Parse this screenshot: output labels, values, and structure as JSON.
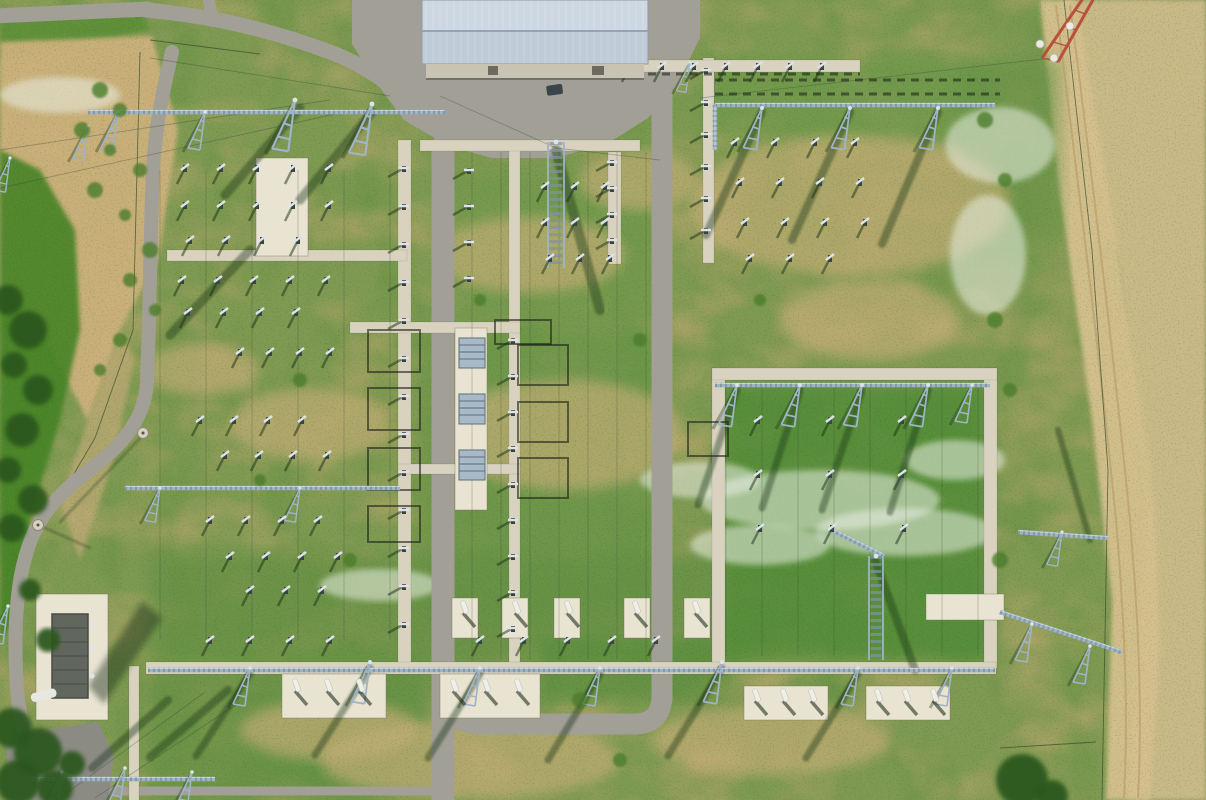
{
  "meta": {
    "title": "Aerial drone view of a high-voltage electrical substation with lattice gantries, access roads and a service building",
    "width": 1206,
    "height": 800
  },
  "palette": {
    "grass_base": "#7f9a52",
    "grass_rich": "#4f8c36",
    "dry_patch": "#bfa96f",
    "dry_patch2": "#c3ae74",
    "sand": "#cdb27c",
    "dry_field": "#c9ba88",
    "track": "#d6c18f",
    "asphalt": "#a19f96",
    "asphalt_dark": "#8c8b83",
    "concrete": "#d9d2bf",
    "concrete_bright": "#e9e3d2",
    "roof": "#bfcbd7",
    "roof_light": "#cdd7e1",
    "roof_ridge": "#93a5b6",
    "wall": "#c9c3b4",
    "steel": "#9fb4c4",
    "steel_light": "#dce4ea",
    "shadow": "rgba(25,48,20,0.5)",
    "frame_dark": "rgba(28,34,24,0.75)",
    "tree": "#2a571f",
    "shrub": "#4c7d2c",
    "flower": "rgba(233,239,227,0.55)",
    "fence": "rgba(60,80,50,0.75)",
    "red_tower": "#b8503a",
    "white": "#efefe8"
  },
  "scene": {
    "regions": [
      {
        "name": "verge-topleft",
        "pts": "0,18 140,8 150,30 60,48 0,60",
        "fill": "#5d9038",
        "op": 0.9
      },
      {
        "name": "sand-topleft",
        "pts": "0,42 152,36 178,130 158,260 120,330 88,420 40,330 0,310",
        "fill": "#cdb27c",
        "op": 0.95
      },
      {
        "name": "sand-tail",
        "pts": "88,420 120,330 135,360 110,470 80,560 60,500",
        "fill": "#c3ac79",
        "op": 0.7
      },
      {
        "name": "left-vegetation",
        "pts": "0,150 40,170 75,230 80,330 60,420 30,520 15,620 0,640",
        "fill": "#468427",
        "op": 0.9
      },
      {
        "name": "right-dry-field",
        "pts": "1062,0 1206,0 1206,800 1128,800 1150,480 1118,260 1068,80",
        "fill": "#c9ba88",
        "op": 1
      },
      {
        "name": "dirt-track",
        "pts": "1040,0 1076,0 1118,250 1152,470 1160,640 1150,800 1106,800 1112,600 1092,420 1058,180",
        "fill": "#d6c18f",
        "op": 0.95
      }
    ],
    "green_blobs": [
      [
        420,
        330,
        240,
        290,
        "#6a9647",
        0.75
      ],
      [
        718,
        382,
        272,
        280,
        "#4f8c36",
        0.8
      ],
      [
        700,
        58,
        300,
        80,
        "#6d9a49",
        0.7
      ],
      [
        150,
        555,
        570,
        110,
        "#659145",
        0.7
      ],
      [
        430,
        175,
        230,
        150,
        "#719a4c",
        0.7
      ],
      [
        540,
        640,
        180,
        60,
        "#568d3a",
        0.6
      ],
      [
        150,
        660,
        280,
        140,
        "#5f9040",
        0.65
      ],
      [
        960,
        60,
        100,
        200,
        "#679447",
        0.6
      ]
    ],
    "dirt_ellipses": [
      [
        530,
        255,
        95,
        38
      ],
      [
        565,
        435,
        120,
        55
      ],
      [
        850,
        205,
        160,
        70
      ],
      [
        310,
        425,
        80,
        36
      ],
      [
        470,
        760,
        150,
        40
      ],
      [
        770,
        740,
        120,
        35
      ],
      [
        640,
        180,
        60,
        30
      ],
      [
        870,
        320,
        90,
        40
      ],
      [
        330,
        730,
        90,
        30
      ],
      [
        200,
        370,
        60,
        25
      ]
    ],
    "flowers": [
      [
        820,
        500,
        120,
        30
      ],
      [
        905,
        532,
        90,
        24
      ],
      [
        760,
        545,
        70,
        20
      ],
      [
        1000,
        145,
        55,
        38
      ],
      [
        988,
        255,
        38,
        60
      ],
      [
        60,
        95,
        60,
        18
      ],
      [
        380,
        585,
        60,
        16
      ],
      [
        700,
        480,
        60,
        18
      ],
      [
        955,
        460,
        50,
        20
      ]
    ],
    "track_lines": [
      "M1056,5 C1075,160 1098,340 1116,520 C1126,640 1128,720 1124,798",
      "M1070,5 C1090,160 1112,340 1130,520 C1140,640 1142,720 1138,798"
    ],
    "fences": [
      "M140,52 L133,330 L95,438 L28,552",
      "M1064,0 L1092,250 L1108,470 L1102,800",
      "M1000,748 L1096,742",
      "M150,40 L260,54"
    ],
    "roads": [
      {
        "name": "road-top-left",
        "d": "M -6,16 L 148,9",
        "w": 15
      },
      {
        "name": "road-top-stub",
        "d": "M 208,-4 L 211,12",
        "w": 12
      },
      {
        "name": "road-top-curve",
        "d": "M 146,10 C 210,16 265,28 330,52 C 352,60 372,72 388,84",
        "w": 15
      },
      {
        "name": "road-left",
        "d": "M 172,52 C 162,95 155,130 153,170 C 150,240 150,310 147,382 C 145,420 120,447 92,468 C 60,492 38,516 28,548 C 18,578 14,620 16,668 C 17,706 22,732 34,748",
        "w": 14
      },
      {
        "name": "road-center-west",
        "d": "M 443,146 L 443,802",
        "w": 23
      },
      {
        "name": "road-loop",
        "d": "M 443,682 C 445,714 458,724 484,724 L 634,724 C 655,724 662,712 662,694",
        "w": 21
      },
      {
        "name": "road-center-east",
        "d": "M 662,92 L 662,700",
        "w": 21
      },
      {
        "name": "road-bottom-path",
        "d": "M 96,791 L 438,791",
        "w": 9
      }
    ],
    "apron_pts": "352,0 700,0 700,38 676,86 648,118 610,142 556,158 492,158 448,146 404,120 380,88 352,44",
    "parking_pts": "6,736 98,722 114,756 108,802 8,802",
    "concrete": [
      [
        398,
        140,
        13,
        528
      ],
      [
        509,
        142,
        11,
        526
      ],
      [
        608,
        152,
        13,
        112
      ],
      [
        703,
        58,
        11,
        205
      ],
      [
        712,
        368,
        13,
        300
      ],
      [
        984,
        368,
        13,
        300
      ],
      [
        129,
        666,
        10,
        136
      ],
      [
        420,
        140,
        220,
        11
      ],
      [
        167,
        250,
        240,
        11
      ],
      [
        350,
        322,
        170,
        11
      ],
      [
        398,
        464,
        122,
        10
      ],
      [
        620,
        60,
        240,
        12
      ],
      [
        712,
        368,
        285,
        12
      ],
      [
        146,
        662,
        850,
        12
      ]
    ],
    "pads": [
      [
        256,
        158,
        52,
        98
      ],
      [
        455,
        328,
        32,
        182
      ],
      [
        282,
        674,
        104,
        44
      ],
      [
        440,
        674,
        100,
        44
      ],
      [
        744,
        686,
        84,
        34
      ],
      [
        866,
        686,
        84,
        34
      ],
      [
        926,
        594,
        78,
        26
      ],
      [
        452,
        598,
        26,
        40
      ],
      [
        502,
        598,
        26,
        40
      ],
      [
        554,
        598,
        26,
        40
      ],
      [
        624,
        598,
        26,
        40
      ],
      [
        684,
        598,
        26,
        40
      ]
    ],
    "wires": {
      "vsets": [
        {
          "x1": 472,
          "x2": 648,
          "step": 29,
          "y1": 152,
          "y2": 660
        },
        {
          "x1": 726,
          "x2": 980,
          "step": 36,
          "y1": 388,
          "y2": 656
        },
        {
          "x1": 160,
          "x2": 390,
          "step": 46,
          "y1": 170,
          "y2": 640
        }
      ],
      "diag": [
        [
          0,
          150,
          330,
          100
        ],
        [
          0,
          188,
          335,
          114
        ],
        [
          150,
          58,
          390,
          96
        ],
        [
          1052,
          58,
          700,
          98
        ],
        [
          60,
          798,
          205,
          692
        ],
        [
          95,
          798,
          240,
          702
        ],
        [
          440,
          96,
          556,
          148
        ],
        [
          556,
          148,
          660,
          160
        ]
      ]
    },
    "dark_rows": [
      [
        715,
        80,
        1000,
        80
      ],
      [
        715,
        94,
        1000,
        94
      ],
      [
        620,
        74,
        860,
        74
      ]
    ],
    "bus_frames": [
      [
        368,
        330,
        52,
        42
      ],
      [
        368,
        388,
        52,
        42
      ],
      [
        368,
        448,
        52,
        42
      ],
      [
        368,
        506,
        52,
        36
      ],
      [
        495,
        320,
        56,
        24
      ],
      [
        518,
        345,
        50,
        40
      ],
      [
        518,
        402,
        50,
        40
      ],
      [
        518,
        458,
        50,
        40
      ],
      [
        688,
        422,
        40,
        34
      ]
    ],
    "shadow_lines": [
      [
        556,
        150,
        600,
        310,
        10
      ],
      [
        875,
        560,
        915,
        670,
        8
      ],
      [
        250,
        250,
        170,
        335,
        9
      ],
      [
        300,
        108,
        225,
        195,
        9
      ],
      [
        372,
        112,
        300,
        200,
        9
      ],
      [
        762,
        112,
        706,
        235,
        8
      ],
      [
        850,
        112,
        792,
        240,
        8
      ],
      [
        938,
        112,
        882,
        244,
        8
      ],
      [
        737,
        390,
        698,
        505,
        7
      ],
      [
        800,
        390,
        762,
        508,
        7
      ],
      [
        862,
        390,
        822,
        510,
        7
      ],
      [
        928,
        390,
        890,
        512,
        7
      ],
      [
        250,
        674,
        196,
        756,
        7
      ],
      [
        370,
        668,
        315,
        755,
        7
      ],
      [
        480,
        674,
        428,
        758,
        7
      ],
      [
        600,
        674,
        548,
        760,
        7
      ],
      [
        722,
        668,
        668,
        756,
        7
      ],
      [
        858,
        674,
        806,
        758,
        7
      ],
      [
        150,
        757,
        228,
        690,
        8
      ],
      [
        92,
        768,
        168,
        700,
        8
      ],
      [
        1090,
        540,
        1058,
        430,
        6
      ],
      [
        143,
        435,
        60,
        522,
        2
      ],
      [
        38,
        525,
        90,
        548,
        2
      ]
    ],
    "gantries": [
      [
        88,
        112,
        445,
        112
      ],
      [
        715,
        105,
        995,
        105
      ],
      [
        715,
        105,
        715,
        150
      ],
      [
        715,
        385,
        990,
        385
      ],
      [
        148,
        670,
        995,
        670
      ],
      [
        125,
        488,
        400,
        488
      ],
      [
        30,
        779,
        215,
        779
      ],
      [
        1000,
        612,
        1122,
        652
      ],
      [
        1018,
        532,
        1108,
        538
      ],
      [
        832,
        530,
        884,
        556
      ]
    ],
    "masts": [
      [
        118,
        112
      ],
      [
        205,
        112
      ],
      [
        295,
        100,
        1.35
      ],
      [
        372,
        104,
        1.35
      ],
      [
        88,
        126,
        0.9
      ],
      [
        762,
        108,
        1.1
      ],
      [
        850,
        108,
        1.1
      ],
      [
        938,
        108,
        1.1
      ],
      [
        737,
        385,
        1.1
      ],
      [
        800,
        385,
        1.1
      ],
      [
        862,
        385,
        1.1
      ],
      [
        928,
        385,
        1.1
      ],
      [
        972,
        385,
        1
      ],
      [
        250,
        668
      ],
      [
        370,
        662,
        1.1
      ],
      [
        480,
        668
      ],
      [
        600,
        668
      ],
      [
        722,
        662,
        1.1
      ],
      [
        858,
        668
      ],
      [
        952,
        668
      ],
      [
        160,
        488,
        0.9
      ],
      [
        300,
        488,
        0.9
      ],
      [
        62,
        772
      ],
      [
        125,
        768
      ],
      [
        192,
        772
      ],
      [
        1032,
        624
      ],
      [
        1090,
        646
      ],
      [
        1062,
        532,
        0.9
      ],
      [
        10,
        158,
        0.9
      ],
      [
        8,
        606
      ],
      [
        690,
        62,
        0.8
      ]
    ],
    "tall_masts": [
      [
        548,
        142,
        16,
        126
      ],
      [
        869,
        556,
        14,
        104
      ]
    ],
    "columns": [
      [
        404,
        168,
        13,
        38
      ],
      [
        513,
        340,
        9,
        36
      ],
      [
        612,
        162,
        4,
        26
      ],
      [
        706,
        70,
        6,
        32
      ],
      [
        469,
        170,
        4,
        36
      ]
    ],
    "switch_rows": [
      [
        185,
        168,
        5,
        36
      ],
      [
        185,
        205,
        5,
        36
      ],
      [
        190,
        240,
        4,
        36
      ],
      [
        182,
        280,
        5,
        36
      ],
      [
        188,
        312,
        4,
        36
      ],
      [
        240,
        352,
        4,
        30
      ],
      [
        200,
        420,
        4,
        34
      ],
      [
        225,
        455,
        4,
        34
      ],
      [
        210,
        520,
        4,
        36
      ],
      [
        230,
        556,
        4,
        36
      ],
      [
        250,
        590,
        3,
        36
      ],
      [
        630,
        66,
        7,
        32
      ],
      [
        735,
        142,
        4,
        40
      ],
      [
        740,
        182,
        4,
        40
      ],
      [
        745,
        222,
        4,
        40
      ],
      [
        750,
        258,
        3,
        40
      ],
      [
        758,
        420,
        3,
        72
      ],
      [
        758,
        474,
        3,
        72
      ],
      [
        760,
        528,
        3,
        72
      ],
      [
        210,
        640,
        4,
        40
      ],
      [
        480,
        640,
        5,
        44
      ],
      [
        545,
        186,
        3,
        30
      ],
      [
        545,
        222,
        3,
        30
      ],
      [
        550,
        258,
        3,
        30
      ]
    ],
    "breaker_pads": [
      [
        292,
        680,
        3,
        32
      ],
      [
        450,
        680,
        3,
        32
      ],
      [
        752,
        690,
        3,
        28
      ],
      [
        874,
        690,
        3,
        28
      ],
      [
        460,
        602,
        1,
        0
      ],
      [
        512,
        602,
        1,
        0
      ],
      [
        564,
        602,
        1,
        0
      ],
      [
        632,
        602,
        1,
        0
      ],
      [
        692,
        602,
        1,
        0
      ]
    ],
    "radiators": [
      [
        459,
        338
      ],
      [
        459,
        394
      ],
      [
        459,
        450
      ]
    ],
    "lamps": [
      [
        38,
        525
      ],
      [
        143,
        433
      ]
    ],
    "building": {
      "x": 422,
      "y": 0,
      "w": 226,
      "ridge": 31,
      "eave": 64,
      "wall_h": 14,
      "doors": [
        [
          488,
          66,
          10,
          9
        ],
        [
          592,
          66,
          12,
          9
        ]
      ]
    },
    "vehicle": [
      546,
      86,
      16,
      10
    ],
    "transformer": {
      "pad": [
        36,
        594,
        72,
        126
      ],
      "body": [
        52,
        614,
        36,
        84
      ],
      "shadow_pts": "88,686 142,602 162,618 104,704",
      "pipe": [
        30,
        694,
        26,
        9
      ]
    },
    "red_tower": {
      "legs": [
        "M1086,-6 L1042,58",
        "M1094,-2 L1058,62"
      ],
      "insulators": [
        [
          1040,
          44
        ],
        [
          1054,
          58
        ],
        [
          1070,
          26
        ]
      ]
    },
    "trees": [
      [
        12,
        728,
        20
      ],
      [
        38,
        752,
        24
      ],
      [
        18,
        782,
        22
      ],
      [
        55,
        788,
        18
      ],
      [
        72,
        764,
        13
      ],
      [
        8,
        300,
        15
      ],
      [
        28,
        330,
        19
      ],
      [
        14,
        365,
        13
      ],
      [
        38,
        390,
        15
      ],
      [
        22,
        430,
        17
      ],
      [
        8,
        470,
        13
      ],
      [
        33,
        500,
        15
      ],
      [
        12,
        528,
        14
      ],
      [
        1022,
        780,
        26
      ],
      [
        1052,
        796,
        16
      ],
      [
        48,
        640,
        12
      ],
      [
        30,
        590,
        11
      ]
    ],
    "shrubs": [
      [
        100,
        90,
        8
      ],
      [
        120,
        110,
        7
      ],
      [
        82,
        130,
        8
      ],
      [
        110,
        150,
        6
      ],
      [
        140,
        170,
        7
      ],
      [
        95,
        190,
        8
      ],
      [
        125,
        215,
        6
      ],
      [
        150,
        250,
        8
      ],
      [
        130,
        280,
        7
      ],
      [
        155,
        310,
        6
      ],
      [
        120,
        340,
        7
      ],
      [
        100,
        370,
        6
      ],
      [
        985,
        120,
        8
      ],
      [
        1005,
        180,
        7
      ],
      [
        995,
        320,
        8
      ],
      [
        1010,
        390,
        7
      ],
      [
        1000,
        560,
        8
      ],
      [
        760,
        300,
        6
      ],
      [
        640,
        340,
        7
      ],
      [
        480,
        300,
        6
      ],
      [
        300,
        380,
        7
      ],
      [
        350,
        560,
        7
      ],
      [
        580,
        700,
        8
      ],
      [
        620,
        760,
        7
      ],
      [
        260,
        480,
        6
      ]
    ]
  }
}
